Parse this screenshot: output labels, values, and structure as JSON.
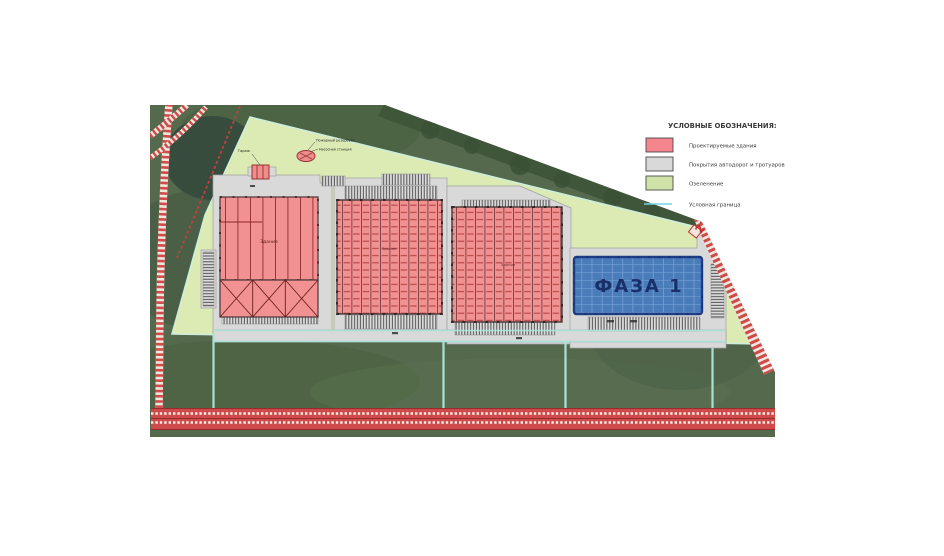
{
  "legend": {
    "title": "УСЛОВНЫЕ ОБОЗНАЧЕНИЯ:",
    "items": [
      {
        "label": "Проектируемые здания",
        "color": "#f4858d"
      },
      {
        "label": "Покрытия автодорог и тротуаров",
        "color": "#d9d9d9"
      },
      {
        "label": "Озеленение",
        "color": "#cfe3a8"
      },
      {
        "label": "Условная граница",
        "color": "#72d4e8"
      }
    ]
  },
  "plan": {
    "phase_label": "ФАЗА 1",
    "road_marker": "22",
    "building_label": "Здание",
    "annotations": {
      "garage": "Гараж",
      "fire_reservoir": "Пожарный резервуар",
      "pump_station": "Насосная станция"
    },
    "colors": {
      "projected_building": "#f19191",
      "paving": "#d9d9d9",
      "greenery": "#dcebb4",
      "boundary": "#9fe0d4",
      "phase1_fill": "#4a7cba",
      "road": "#cf4a4a"
    }
  }
}
